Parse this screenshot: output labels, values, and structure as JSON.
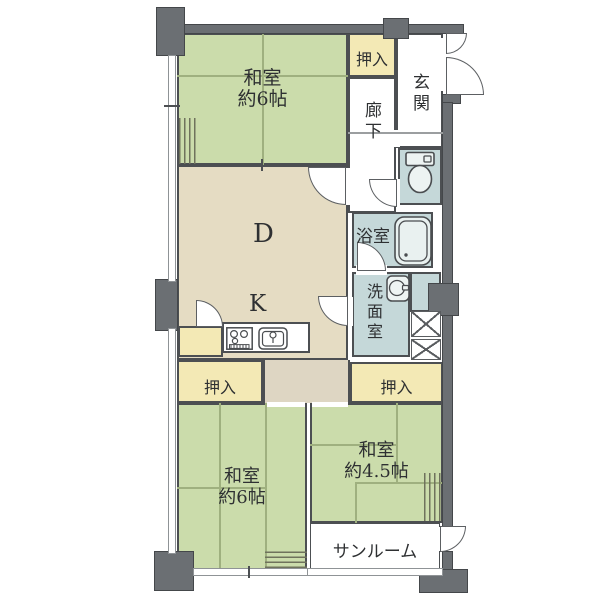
{
  "rooms": {
    "washitsu_top": {
      "name": "和室",
      "size": "約6帖"
    },
    "washitsu_bottom_left": {
      "name": "和室",
      "size": "約6帖"
    },
    "washitsu_bottom_right": {
      "name": "和室",
      "size": "約4.5帖"
    },
    "dining": {
      "label": "D"
    },
    "kitchen": {
      "label": "K"
    },
    "entrance": {
      "label": "玄関"
    },
    "corridor": {
      "label": "廊下"
    },
    "bathroom": {
      "label": "浴室"
    },
    "washroom": {
      "label": "洗面室"
    },
    "sunroom": {
      "label": "サンルーム"
    },
    "closet_top": {
      "label": "押入"
    },
    "closet_bottom_left": {
      "label": "押入"
    },
    "closet_bottom_right": {
      "label": "押入"
    }
  },
  "colors": {
    "tatami_green": "#cbdcab",
    "closet_cream": "#f3e9b5",
    "dk_tan": "#e5dcc3",
    "wet_blue": "#c5d8d9",
    "wall_gray": "#6b6f73",
    "outline": "#4c4f52"
  }
}
